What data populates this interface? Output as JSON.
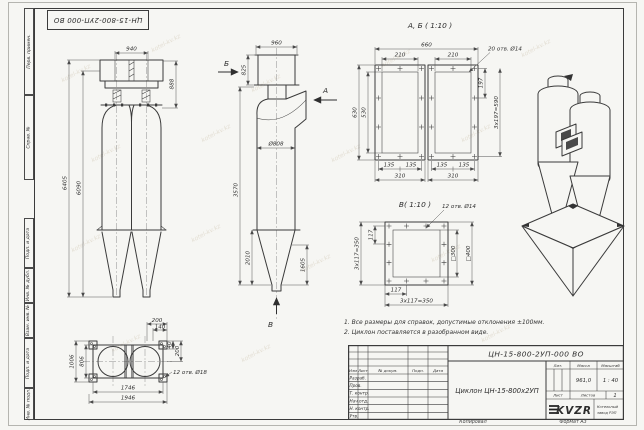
{
  "sheet": {
    "stamp_top": "ЦН-15-800-2УП-000 ВО",
    "watermark": "kotel-kv.kz",
    "footer": {
      "copied": "Копировал",
      "format": "Формат А3"
    }
  },
  "side_labels": [
    "Перв. примен.",
    "Справ. №",
    "Подп. и дата",
    "Инв. № дубл.",
    "Взам. инв. №",
    "Подп. и дата",
    "Инв. № подл."
  ],
  "views": {
    "front": {
      "dims": {
        "top": "940",
        "right": "888",
        "outer": "6405",
        "inner": "6090"
      }
    },
    "side": {
      "dims": {
        "top": "960",
        "box": "825",
        "body": "3570",
        "dia": "Ø808",
        "cone": "2010",
        "outlet": "1605"
      },
      "arrows": {
        "a": "А",
        "b": "Б",
        "v": "В"
      }
    },
    "flange_ab": {
      "title": "А, Б ( 1:10 )",
      "dims": {
        "total": "660",
        "w": "210",
        "holes": "20 отв. Ø14",
        "pitch": "197",
        "pitch_total": "3х197=590",
        "inner": "530",
        "outer": "630",
        "s135": "135",
        "s310": "310"
      }
    },
    "flange_v": {
      "title": "В( 1:10 )",
      "dims": {
        "holes": "12 отв. Ø14",
        "pitch": "117",
        "pitch_total": "3х117=350",
        "sq_inner": "□300",
        "sq_outer": "□400"
      }
    },
    "bottom": {
      "dims": {
        "w200": "200",
        "w140": "140",
        "h40": "40",
        "h200": "200",
        "h1006": "1006",
        "h806": "806",
        "w1746": "1746",
        "w1946": "1946",
        "holes": "12 отв. Ø18"
      }
    }
  },
  "notes": [
    "1. Все размеры для справок, допустимые отклонения ±100мм.",
    "2. Циклон поставляется в разобранном виде."
  ],
  "title_block": {
    "doc_number": "ЦН-15-800-2УП-000 ВО",
    "name": "Циклон ЦН-15-800х2УП",
    "cols": [
      "Изм",
      "Лист",
      "№ докум.",
      "Подп.",
      "Дата"
    ],
    "rows": [
      "Разраб.",
      "Пров.",
      "Т. контр.",
      "Нач.отд.",
      "Н. контр.",
      "Утв."
    ],
    "lit": "Лит.",
    "mass": "Масса",
    "scale": "Масштаб",
    "mass_value": "961,0",
    "scale_value": "1 : 40",
    "sheet": "Лист",
    "sheets": "Листов",
    "sheets_value": "1",
    "logo": "KVZR",
    "company_line1": "Котельный",
    "company_line2": "завод РЭП"
  }
}
